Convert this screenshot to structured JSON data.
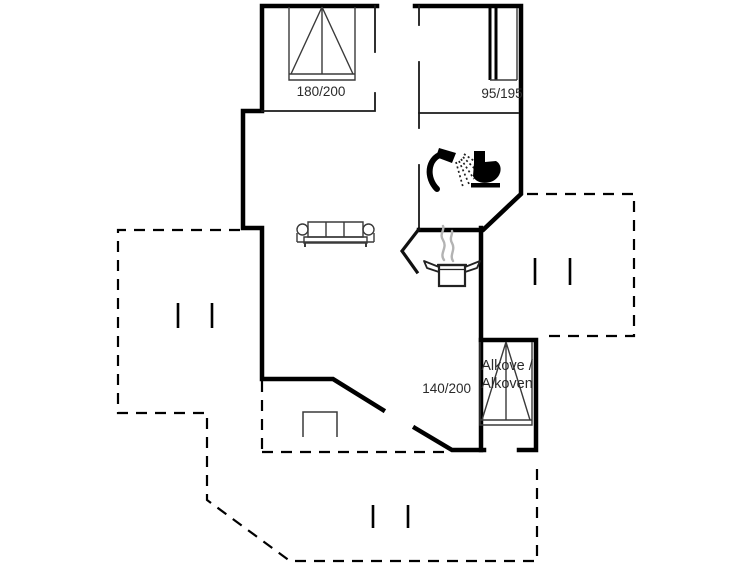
{
  "floor_plan": {
    "labels": {
      "double_bed_size": "180/200",
      "bunk_bed_size": "95/195",
      "alcove_bed_size": "140/200",
      "alcove_name_line1": "Alkove /",
      "alcove_name_line2": "Alkoven"
    },
    "icons": {
      "shower": "shower-icon",
      "toilet": "toilet-icon",
      "cooking_pot": "cooking-pot-icon",
      "sofa": "sofa-icon",
      "double_bed": "double-bed-icon",
      "bunk_bed": "bunk-bed-icon",
      "alcove_bed": "alcove-bed-icon"
    },
    "colors": {
      "walls": "#000000",
      "furniture_outline": "#3a3a3a",
      "steam": "#b3b3b3",
      "text": "#2a2a2a",
      "background": "#ffffff"
    }
  }
}
